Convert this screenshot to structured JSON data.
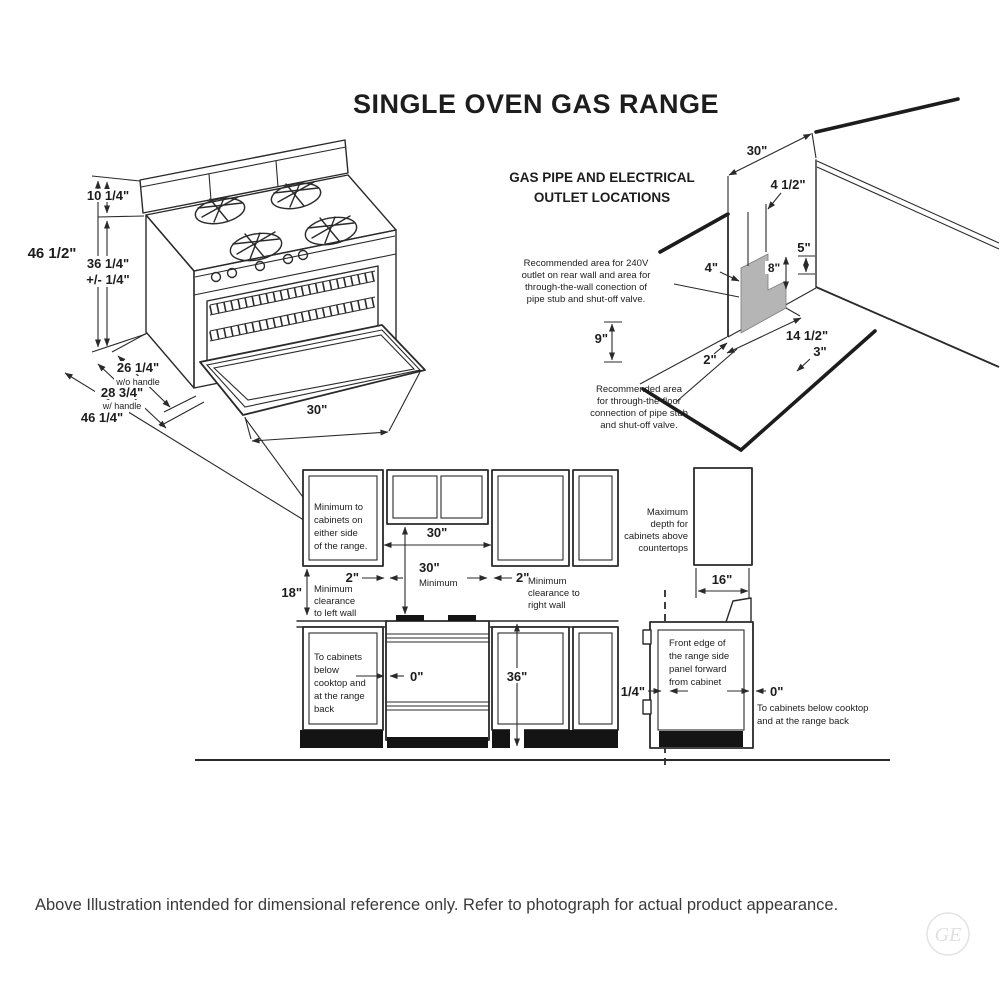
{
  "title": "SINGLE OVEN GAS RANGE",
  "footer": "Above Illustration intended for dimensional reference only. Refer to photograph for actual product appearance.",
  "logo_monogram": "GE",
  "range_isometric": {
    "dim_total_height": "46 1/2\"",
    "dim_backsplash_height": "10 1/4\"",
    "dim_cooktop_height": "36 1/4\"",
    "dim_cooktop_tolerance": "+/- 1/4\"",
    "dim_depth_no_handle": "26 1/4\"",
    "note_no_handle": "w/o handle",
    "dim_depth_handle": "28 3/4\"",
    "note_handle": "w/ handle",
    "dim_depth_door_open": "46 1/4\"",
    "dim_width": "30\""
  },
  "gas_pipe_diagram": {
    "heading_line1": "GAS PIPE AND ELECTRICAL",
    "heading_line2": "OUTLET LOCATIONS",
    "note_wall": [
      "Recommended area for 240V",
      "outlet on rear wall and area for",
      "through-the-wall conection of",
      "pipe stub and shut-off valve."
    ],
    "note_floor": [
      "Recommended area",
      "for through-the-floor",
      "connection of pipe stub",
      "and shut-off valve."
    ],
    "dim_opening_width": "30\"",
    "dim_4_5": "4 1/2\"",
    "dim_5": "5\"",
    "dim_4": "4\"",
    "dim_8": "8\"",
    "dim_9": "9\"",
    "dim_2": "2\"",
    "dim_14_5": "14 1/2\"",
    "dim_3": "3\""
  },
  "front_elevation": {
    "note_side_cabinets": [
      "Minimum to",
      "cabinets on",
      "either side",
      "of the range."
    ],
    "dim_opening": "30\"",
    "dim_min_vertical": "30\"",
    "min_vertical_word": "Minimum",
    "dim_left_gap": "2\"",
    "note_left_wall": [
      "Minimum",
      "clearance",
      "to left wall"
    ],
    "dim_right_gap": "2\"",
    "note_right_wall": [
      "Minimum",
      "clearance to",
      "right wall"
    ],
    "dim_18": "18\"",
    "note_below_cooktop": [
      "To cabinets",
      "below",
      "cooktop and",
      "at the range",
      "back"
    ],
    "dim_zero": "0\"",
    "dim_36": "36\""
  },
  "side_elevation": {
    "note_max_depth": [
      "Maximum",
      "depth for",
      "cabinets above",
      "countertops"
    ],
    "dim_16": "16\"",
    "note_front_edge": [
      "Front edge of",
      "the range side",
      "panel forward",
      "from cabinet"
    ],
    "dim_quarter": "1/4\"",
    "dim_zero": "0\"",
    "note_zero": [
      "To cabinets below cooktop",
      "and at the range back"
    ]
  }
}
